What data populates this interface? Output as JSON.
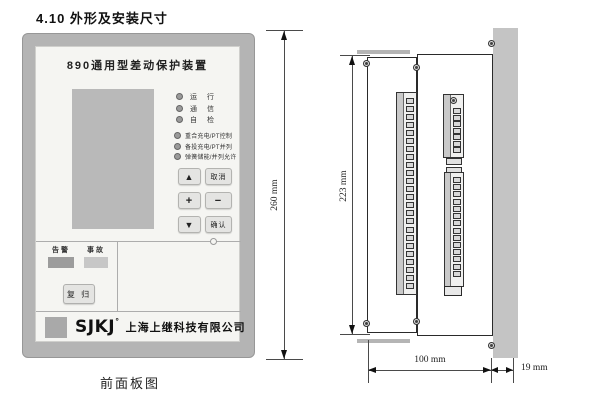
{
  "page": {
    "heading": "4.10 外形及安装尺寸",
    "front_caption": "前面板图"
  },
  "front_panel": {
    "title": "890通用型差动保护装置",
    "leds_status": [
      {
        "label": "运 行"
      },
      {
        "label": "通 信"
      },
      {
        "label": "自 检"
      }
    ],
    "leds_function": [
      {
        "label": "重合充电/PT控制"
      },
      {
        "label": "备投充电/PT并列"
      },
      {
        "label": "弹簧储能/并列允许"
      }
    ],
    "keypad": {
      "up": "▲",
      "cancel": "取消",
      "plus": "+",
      "minus": "−",
      "down": "▼",
      "confirm": "确认"
    },
    "alarm_label": "告警",
    "fault_label": "事故",
    "reset_label": "复 归",
    "brand": {
      "logo_text": "SJKJ",
      "reg_mark": "°",
      "company": "上海上继科技有限公司"
    }
  },
  "dimensions": {
    "front_height": "260 mm",
    "side_height": "223 mm",
    "body_depth": "100 mm",
    "rear_depth": "19 mm"
  },
  "side_view": {
    "left_strip_cells": 24,
    "right_upper_cells": 7,
    "right_lower_cells": 14
  },
  "colors": {
    "panel-frame": "#b4b4b4",
    "panel-face": "#f5f5f2",
    "lcd": "#b9b9b9",
    "button-face": "#e4e4e2",
    "alarm-box": "#9c9c9c",
    "fault-box": "#c7c7c7",
    "logo-square": "#a9a9a9",
    "mount-panel": "#c4c4c4",
    "outline": "#2a2a2a",
    "dim-line": "#4a4a4a"
  }
}
